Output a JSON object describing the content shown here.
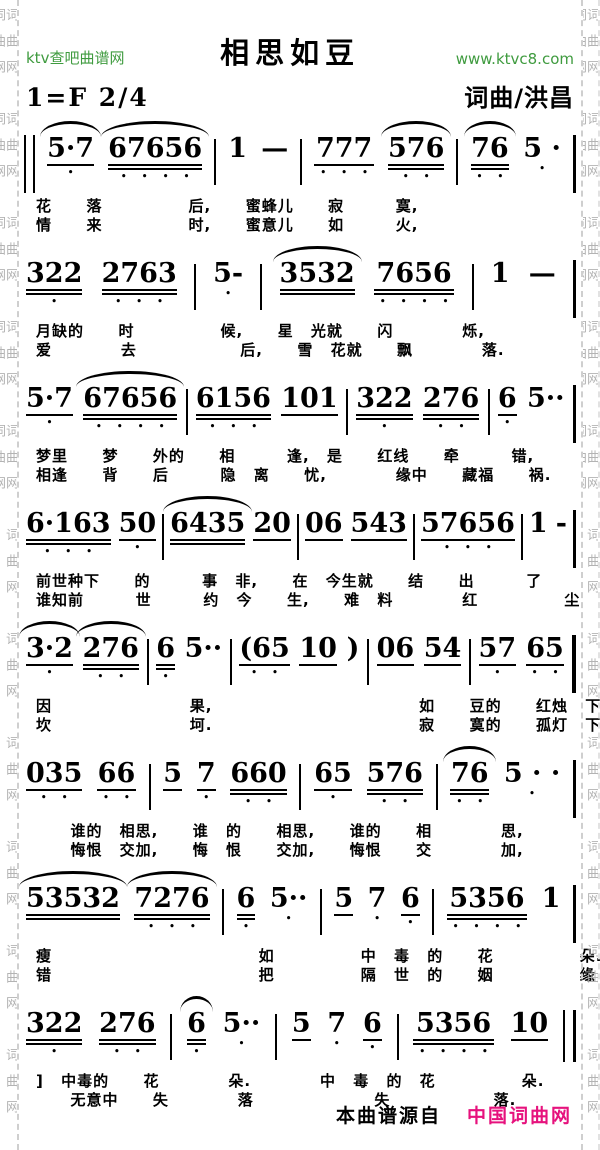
{
  "header": {
    "site_left": "ktv查吧曲谱网",
    "site_right": "www.ktvc8.com",
    "title": "相思如豆",
    "key": "1=F  2/4",
    "credit": "词曲/洪昌"
  },
  "border": {
    "chars": "词曲网",
    "repeat": 16
  },
  "colors": {
    "site_green": "#3f9b3f",
    "footer_pink": "#e6127d",
    "border_gray": "#b3b3b3",
    "ink": "#000000"
  },
  "systems": [
    {
      "tokens": [
        {
          "bar": "open"
        },
        {
          "t": "5·7",
          "u": 1,
          "d": 1,
          "s": 1
        },
        {
          "t": "67656",
          "u": 2,
          "d": 4,
          "s": 1
        },
        {
          "bar": "s"
        },
        {
          "t": "1"
        },
        {
          "t": "—"
        },
        {
          "bar": "s"
        },
        {
          "t": "777",
          "u": 1,
          "d": 3
        },
        {
          "t": "576",
          "u": 2,
          "d": 2,
          "s": 1
        },
        {
          "bar": "s"
        },
        {
          "t": "76",
          "u": 2,
          "d": 2,
          "s": 1
        },
        {
          "t": "5 ·",
          "d": 1
        },
        {
          "bar": "end1"
        }
      ],
      "lyrics": [
        "花  落     后,  蜜蜂儿  寂   寞,",
        "情  来     时,  蜜意儿  如   火,"
      ]
    },
    {
      "tokens": [
        {
          "t": "322",
          "u": 2,
          "d": 1
        },
        {
          "t": "2763",
          "u": 2,
          "d": 3
        },
        {
          "bar": "s"
        },
        {
          "t": "5-",
          "d": 1
        },
        {
          "bar": "s"
        },
        {
          "t": "3532",
          "u": 2,
          "s": 1
        },
        {
          "t": "7656",
          "u": 2,
          "d": 4
        },
        {
          "bar": "s"
        },
        {
          "t": "1"
        },
        {
          "t": "—"
        },
        {
          "bar": "end1"
        }
      ],
      "lyrics": [
        "月缺的  时     候,  星 光就  闪    烁,",
        "爱    去      后,  雪 花就  飘    落."
      ]
    },
    {
      "tokens": [
        {
          "t": "5·7",
          "u": 1,
          "d": 1
        },
        {
          "t": "67656",
          "u": 2,
          "d": 4,
          "s": 1
        },
        {
          "bar": "s"
        },
        {
          "t": "6156",
          "u": 2,
          "d": 3
        },
        {
          "t": "101",
          "u": 1
        },
        {
          "bar": "s"
        },
        {
          "t": "322",
          "u": 2,
          "d": 1
        },
        {
          "t": "276",
          "u": 2,
          "d": 2
        },
        {
          "bar": "s"
        },
        {
          "t": "6",
          "u": 1,
          "d": 1
        },
        {
          "t": "5··"
        },
        {
          "bar": "end1"
        }
      ],
      "lyrics": [
        "梦里  梦  外的  相   逢, 是  红线  牵   错,",
        "相逢  背  后   隐 离  忧,    缘中  藏福  祸."
      ]
    },
    {
      "tokens": [
        {
          "t": "6·163",
          "u": 2,
          "d": 3
        },
        {
          "t": "50",
          "u": 1,
          "d": 1
        },
        {
          "bar": "s"
        },
        {
          "t": "6435",
          "u": 2,
          "s": 1
        },
        {
          "t": "20",
          "u": 1
        },
        {
          "bar": "s"
        },
        {
          "t": "06",
          "u": 1
        },
        {
          "t": "543",
          "u": 1
        },
        {
          "bar": "s"
        },
        {
          "t": "57656",
          "u": 1,
          "d": 3
        },
        {
          "bar": "s"
        },
        {
          "t": "1"
        },
        {
          "t": "-"
        },
        {
          "bar": "end1"
        }
      ],
      "lyrics": [
        "前世种下  的   事 非,  在 今生就  结  出   了",
        "谁知前   世   约 今  生,  难 料    红     尘"
      ]
    },
    {
      "tokens": [
        {
          "t": "3·2",
          "u": 1,
          "d": 1,
          "s": 1
        },
        {
          "t": "276",
          "u": 2,
          "d": 2,
          "s": 1
        },
        {
          "bar": "s"
        },
        {
          "t": "6",
          "u": 2,
          "d": 1
        },
        {
          "t": "5··"
        },
        {
          "bar": "s"
        },
        {
          "t": "(65",
          "u": 1,
          "d": 2
        },
        {
          "t": "10",
          "u": 1
        },
        {
          "t": ")"
        },
        {
          "bar": "s"
        },
        {
          "t": "06",
          "u": 1
        },
        {
          "t": "54",
          "u": 1
        },
        {
          "bar": "s"
        },
        {
          "t": "57",
          "u": 1,
          "d": 1
        },
        {
          "t": "65",
          "u": 1,
          "d": 2
        },
        {
          "bar": "end2"
        }
      ],
      "lyrics": [
        "因        果,            如  豆的  红烛 下",
        "坎        坷.            寂  寞的  孤灯 下,"
      ]
    },
    {
      "tokens": [
        {
          "t": "035",
          "u": 1,
          "d": 2
        },
        {
          "t": "66",
          "u": 1,
          "d": 2
        },
        {
          "bar": "s"
        },
        {
          "t": "5",
          "u": 1
        },
        {
          "t": "7",
          "u": 1,
          "d": 1
        },
        {
          "t": "660",
          "u": 2,
          "d": 2
        },
        {
          "bar": "s"
        },
        {
          "t": "65",
          "u": 1,
          "d": 1
        },
        {
          "t": "576",
          "u": 2,
          "d": 2
        },
        {
          "bar": "s"
        },
        {
          "t": "76",
          "u": 2,
          "d": 2,
          "s": 1
        },
        {
          "t": "5 · ·",
          "d": 1
        },
        {
          "bar": "end1"
        }
      ],
      "lyrics": [
        "  谁的 相思,  谁 的  相思,  谁的  相    思,",
        "  悔恨 交加,  悔 恨  交加,  悔恨  交    加,"
      ]
    },
    {
      "tokens": [
        {
          "t": "53532",
          "u": 2,
          "s": 1
        },
        {
          "t": "7276",
          "u": 2,
          "d": 3,
          "s": 1
        },
        {
          "bar": "s"
        },
        {
          "t": "6",
          "u": 2,
          "d": 1
        },
        {
          "t": "5··",
          "d": 1
        },
        {
          "bar": "s"
        },
        {
          "t": "5",
          "u": 1
        },
        {
          "t": "7",
          "d": 1
        },
        {
          "t": "6",
          "u": 1,
          "d": 1
        },
        {
          "bar": "s"
        },
        {
          "t": "5356",
          "u": 2,
          "d": 4
        },
        {
          "t": "1"
        },
        {
          "bar": "end1"
        }
      ],
      "lyrics": [
        "瘦            如     中 毒 的  花     朵.",
        "错            把     隔 世 的  姻     缘"
      ]
    },
    {
      "tokens": [
        {
          "t": "322",
          "u": 2,
          "d": 1
        },
        {
          "t": "276",
          "u": 2,
          "d": 2
        },
        {
          "bar": "s"
        },
        {
          "t": "6",
          "u": 2,
          "d": 1,
          "s": 1
        },
        {
          "t": "5··",
          "d": 1
        },
        {
          "bar": "s"
        },
        {
          "t": "5",
          "u": 1
        },
        {
          "t": "7",
          "d": 1
        },
        {
          "t": "6",
          "u": 1,
          "d": 1
        },
        {
          "bar": "s"
        },
        {
          "t": "5356",
          "u": 2,
          "d": 4
        },
        {
          "t": "10",
          "u": 1
        },
        {
          "bar": "dend"
        }
      ],
      "lyrics": [
        "] 中毒的  花    朵.    中 毒 的 花     朵.",
        "  无意中  失    落       失      落."
      ]
    }
  ],
  "footer": {
    "source_label": "本曲谱源自",
    "source_site": "中国词曲网"
  }
}
